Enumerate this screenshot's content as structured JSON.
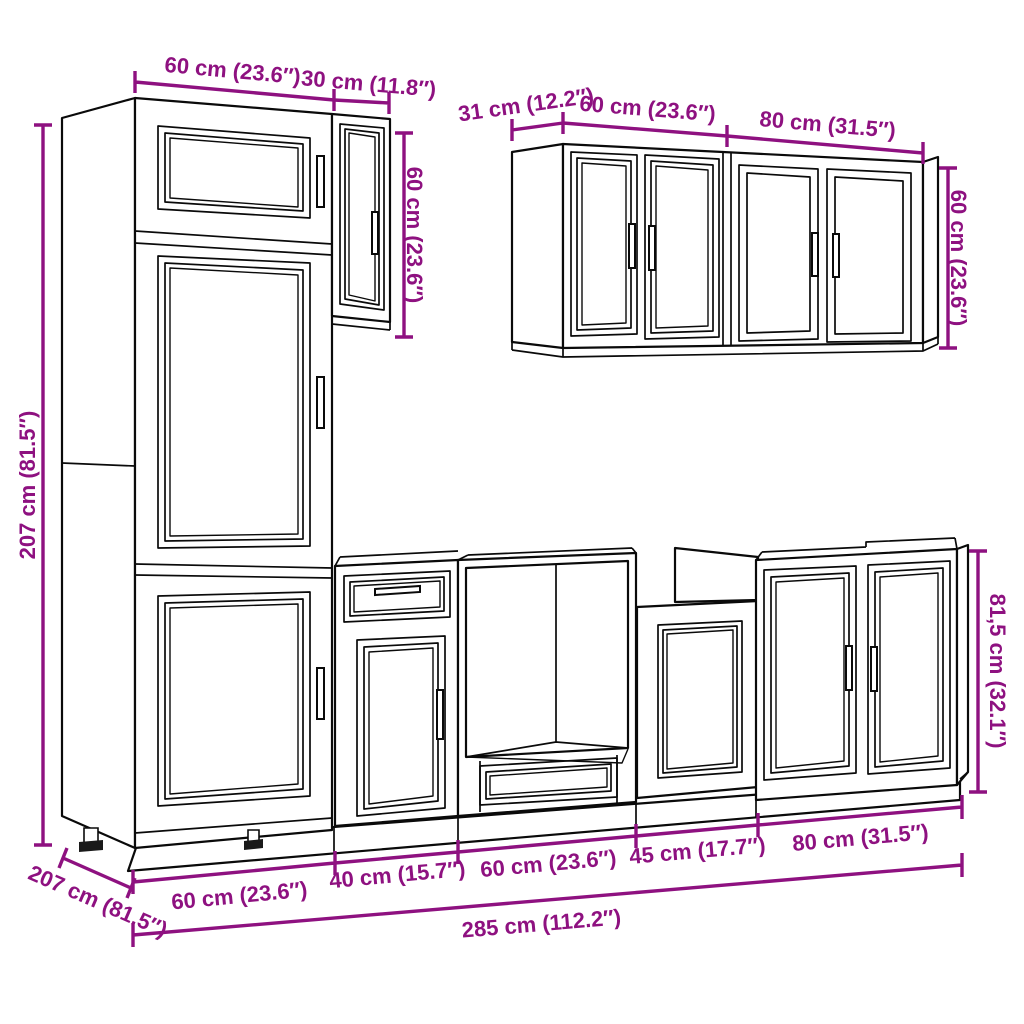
{
  "image": {
    "kind": "furniture dimension diagram",
    "subject": "kitchen cabinet set line drawing with measurements"
  },
  "colors": {
    "background": "#ffffff",
    "drawing_line": "#0a0a0a",
    "dimension": "#8e1180"
  },
  "dimensions": {
    "tall_width_top": "60 cm (23.6″)",
    "small_wall_width": "30 cm (11.8″)",
    "small_wall_height": "60 cm (23.6″)",
    "wall_depth": "31 cm (12.2″)",
    "wall60_width": "60 cm (23.6″)",
    "wall80_width": "80 cm (31.5″)",
    "wall_height": "60 cm (23.6″)",
    "tall_height": "207 cm (81.5″)",
    "base_height": "81,5 cm (32.1″)",
    "base_seg1": "60 cm (23.6″)",
    "base_seg2": "40 cm (15.7″)",
    "base_seg3": "60 cm (23.6″)",
    "base_seg4": "45 cm (17.7″)",
    "base_seg5": "80 cm (31.5″)",
    "total_width": "285 cm (112.2″)",
    "depth_diagonal": "207 cm (81.5″)"
  }
}
